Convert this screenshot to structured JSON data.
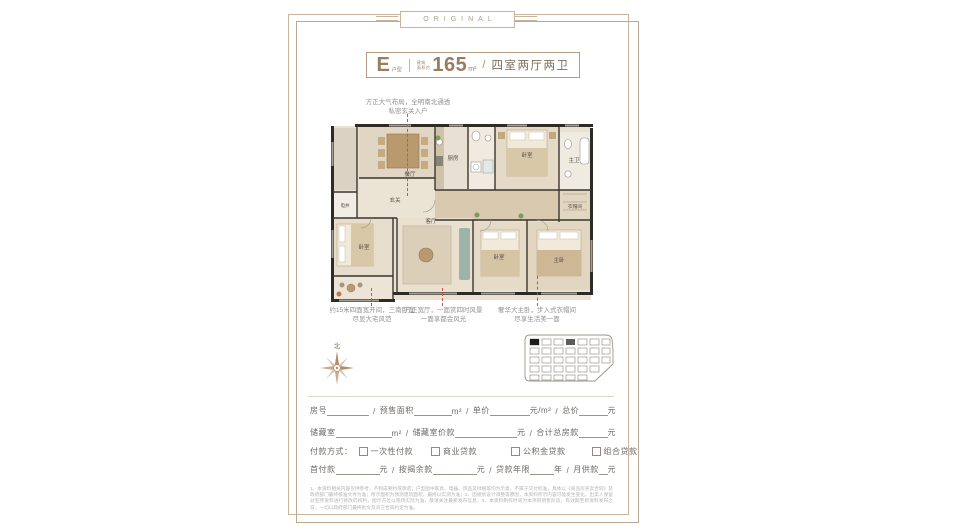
{
  "page": {
    "badge": "ORIGINAL"
  },
  "title": {
    "type_letter": "E",
    "type_suffix": "户型",
    "area_label1": "建筑",
    "area_label2": "面积约",
    "area_value": "165",
    "area_unit": "m²",
    "separator": "/",
    "layout": "四室两厅两卫"
  },
  "annotations": {
    "top_line1": "方正大气布局，全明南北通透",
    "top_line2": "私密玄关入户",
    "bottom": [
      {
        "line1": "约15米四面宽开间，三南卧室",
        "line2": "尽显大宅风范"
      },
      {
        "line1": "方正宽厅，一面赏四时风景",
        "line2": "一面享都会风光"
      },
      {
        "line1": "奢华大主卧，步入式衣帽间",
        "line2": "尽享生活美一面"
      }
    ]
  },
  "plan": {
    "compass_north": "北",
    "rooms": [
      {
        "label": "餐厅"
      },
      {
        "label": "玄关"
      },
      {
        "label": "电井"
      },
      {
        "label": "厨房"
      },
      {
        "label": "卧室"
      },
      {
        "label": "主卫"
      },
      {
        "label": "衣帽间"
      },
      {
        "label": "客厅"
      },
      {
        "label": "卧室"
      },
      {
        "label": "卧室"
      },
      {
        "label": "主卧"
      }
    ]
  },
  "form": {
    "sep": "/",
    "units": {
      "sqm": "m²",
      "yuan": "元",
      "yuan_per_sqm": "元/m²",
      "year": "年"
    },
    "row1": {
      "f1": "房号",
      "f2": "预售面积",
      "f3": "单价",
      "f4": "总价"
    },
    "row2": {
      "f1": "储藏室",
      "f2": "储藏室价款",
      "f3": "合计总房款"
    },
    "row3": {
      "label": "付款方式：",
      "options": [
        {
          "label": "一次性付款"
        },
        {
          "label": "商业贷款"
        },
        {
          "label": "公积金贷款"
        },
        {
          "label": "组合贷款"
        }
      ]
    },
    "row4": {
      "f1": "首付款",
      "f2": "按揭余款",
      "f3": "贷款年限",
      "f4": "月供款"
    }
  },
  "disclaimer": {
    "text": "1、本资料相关内容仅供参考，不构成要约或承诺；户型图中家具、电器、饰品及绿植等均为示意，不属于交付标准，具体以《商品房买卖合同》及政府部门最终核准文件为准；所示面积为预测建筑面积，最终以实测为准；2、因规划设计调整等原因，本资料所示内容可能发生变化，出卖人保留对宣传资料进行修改的权利，图示方位以现场实际为准，敬请关注最新发布信息；3、本资料制作时间为本项目销售阶段，有效期至新资料发布之日，一切以政府部门最终批文及双方合同约定为准。"
  },
  "colors": {
    "accent": "#9a7c5e",
    "frame": "#c9b49d",
    "guide_line": "#cc5248"
  }
}
